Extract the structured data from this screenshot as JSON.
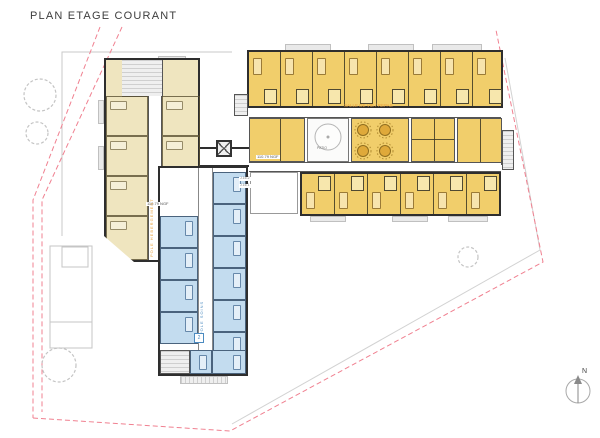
{
  "title": "PLAN ETAGE COURANT",
  "labels": {
    "patio": "PATIO",
    "dining_unit": "SALLE DE VIE / REPAS",
    "care_unit": "POLE SOINS",
    "accommodation_unit": "POLE HEBERGEMENT",
    "level_left": "110.79 NGF",
    "level_right": "110.79 NGF",
    "ref_top": "J.16.2",
    "ref_bottom": "J.16.1",
    "stair_marker": "2",
    "north": "N"
  },
  "legend_colors": {
    "bedroom_yellow": "#F1CE6B",
    "bedroom_pale": "#EFE5BF",
    "care_blue": "#C3DCEF",
    "boundary_red": "#F08090",
    "unit_label_orange": "#E8A23C",
    "care_label_blue": "#4C8BC0",
    "wall": "#2E2E2E"
  }
}
